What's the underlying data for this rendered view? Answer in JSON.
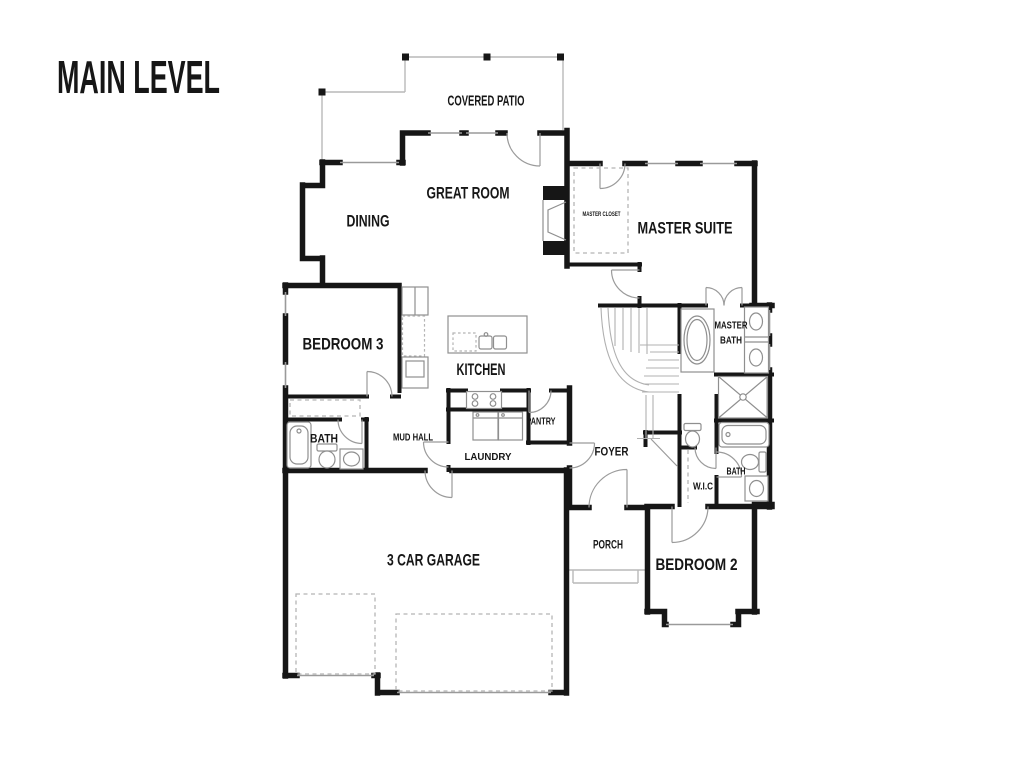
{
  "title": "MAIN LEVEL",
  "colors": {
    "wall": "#161616",
    "window_glass": "#9a9a9a",
    "door_swing": "#9b9b9b",
    "fixture": "#8f8f8f",
    "stair": "#b0b0b0",
    "dashed": "#b5b5b5",
    "patio_line": "#b9b9b9",
    "background": "#ffffff",
    "text": "#161616"
  },
  "rooms": {
    "covered_patio": {
      "label": "COVERED PATIO"
    },
    "great_room": {
      "label": "GREAT ROOM"
    },
    "dining": {
      "label": "DINING"
    },
    "master_closet": {
      "label": "MASTER CLOSET"
    },
    "master_suite": {
      "label": "MASTER SUITE"
    },
    "master_bath": {
      "lines": [
        "MASTER",
        "BATH"
      ]
    },
    "bedroom3": {
      "label": "BEDROOM 3"
    },
    "kitchen": {
      "label": "KITCHEN"
    },
    "bath_left": {
      "label": "BATH"
    },
    "mud_hall": {
      "label": "MUD HALL"
    },
    "pantry": {
      "label": "PANTRY"
    },
    "laundry": {
      "label": "LAUNDRY"
    },
    "foyer": {
      "label": "FOYER"
    },
    "wic": {
      "label": "W.I.C"
    },
    "bath_right": {
      "label": "BATH"
    },
    "porch": {
      "label": "PORCH"
    },
    "bedroom2": {
      "label": "BEDROOM 2"
    },
    "garage": {
      "label": "3 CAR GARAGE"
    }
  }
}
